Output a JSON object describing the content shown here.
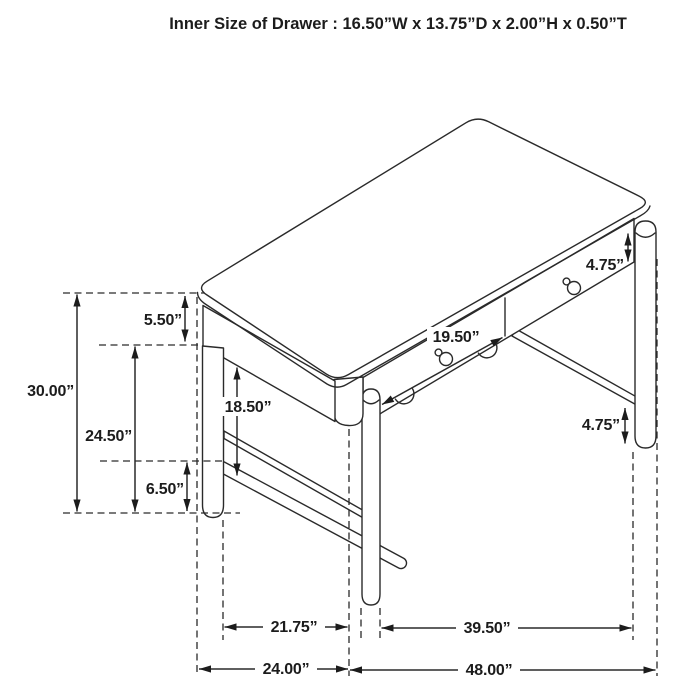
{
  "title": "Inner Size of Drawer : 16.50”W x 13.75”D x 2.00”H x 0.50”T",
  "diagram": {
    "subject": "writing-desk isometric line drawing with dimension callouts",
    "line_color": "#2a2a2a",
    "background_color": "#ffffff"
  },
  "dimensions": {
    "overall_height": "30.00”",
    "top_to_apron_bottom": "5.50”",
    "floor_to_apron_bottom": "24.50”",
    "apron_to_stretcher": "18.50”",
    "stretcher_to_floor": "6.50”",
    "drawer_front_width": "19.50”",
    "drawer_front_height": "4.75”",
    "leg_below_stretcher": "4.75”",
    "inner_leg_span_depth": "21.75”",
    "inner_leg_span_width": "39.50”",
    "overall_depth": "24.00”",
    "overall_width": "48.00”"
  }
}
